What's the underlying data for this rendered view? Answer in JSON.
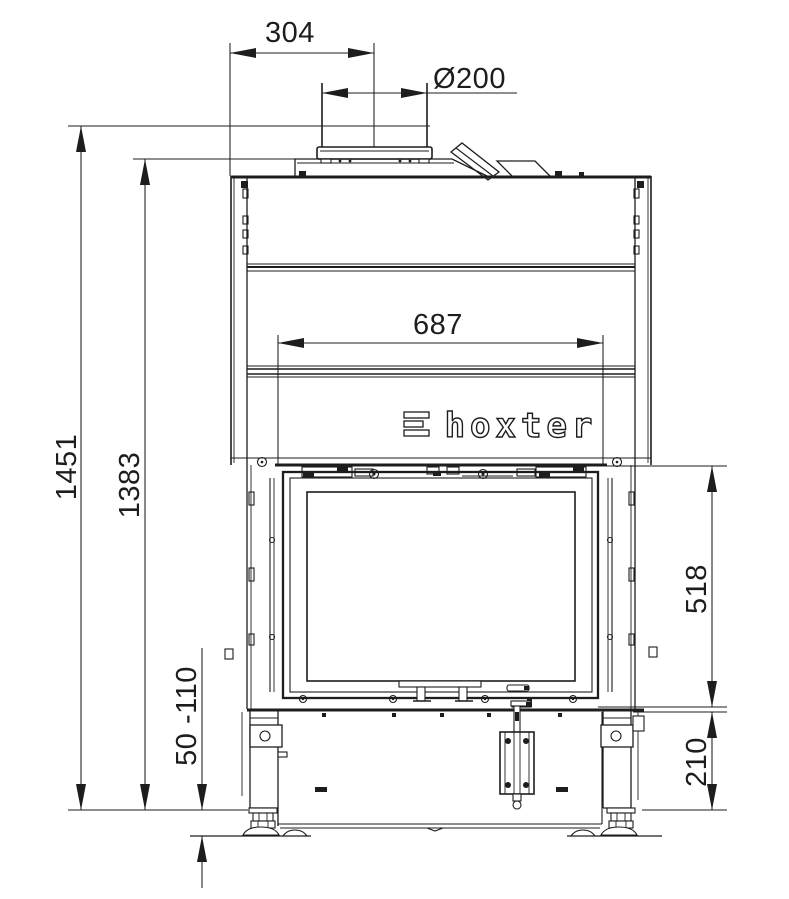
{
  "drawing": {
    "brand": "hoxter",
    "brand_mark": "≡",
    "dimensions": {
      "flue_offset": "304",
      "flue_diameter": "Ø200",
      "opening_width": "687",
      "total_height": "1451",
      "body_height": "1383",
      "leg_adjustment": "50 -110",
      "door_height": "518",
      "base_height": "210"
    }
  }
}
